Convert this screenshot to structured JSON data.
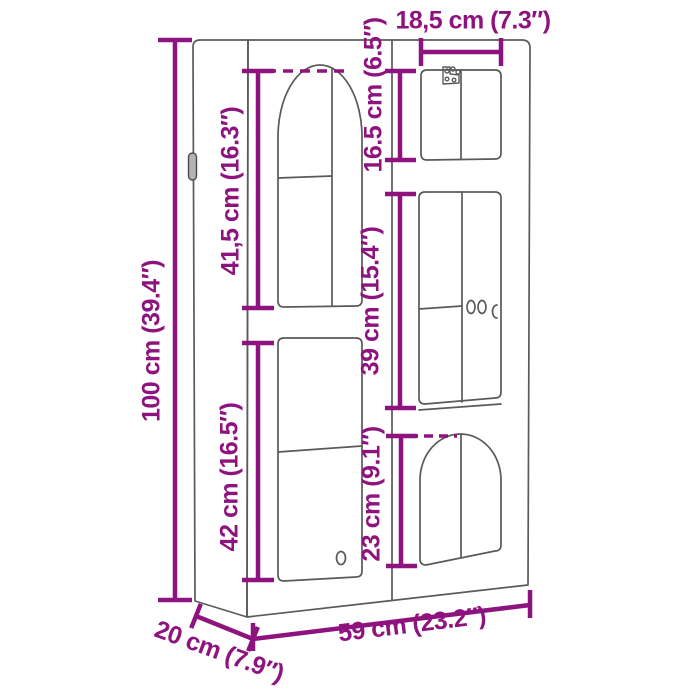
{
  "diagram": {
    "type": "product-dimension-diagram",
    "subject": "wall cabinet with arched glass doors",
    "accent_color": "#8f137e",
    "outline_color": "#5a5a5a",
    "units": [
      "cm",
      "inches"
    ],
    "labels": {
      "overall_height": "100 cm (39.4″)",
      "overall_width": "59 cm (23.2″)",
      "overall_depth": "20 cm (7.9″)",
      "top_compartment_width": "18,5 cm (7.3″)",
      "top_compartment_height": "16.5 cm (6.5″)",
      "upper_left_door_height": "41,5 cm (16.3″)",
      "middle_right_door_height": "39 cm (15.4″)",
      "lower_left_door_height": "42 cm (16.5″)",
      "lower_right_door_height": "23 cm (9.1″)"
    },
    "values_cm": {
      "overall_height": 100,
      "overall_width": 59,
      "overall_depth": 20,
      "top_compartment_width": 18.5,
      "top_compartment_height": 16.5,
      "upper_left_door_height": 41.5,
      "middle_right_door_height": 39,
      "lower_left_door_height": 42,
      "lower_right_door_height": 23
    }
  }
}
